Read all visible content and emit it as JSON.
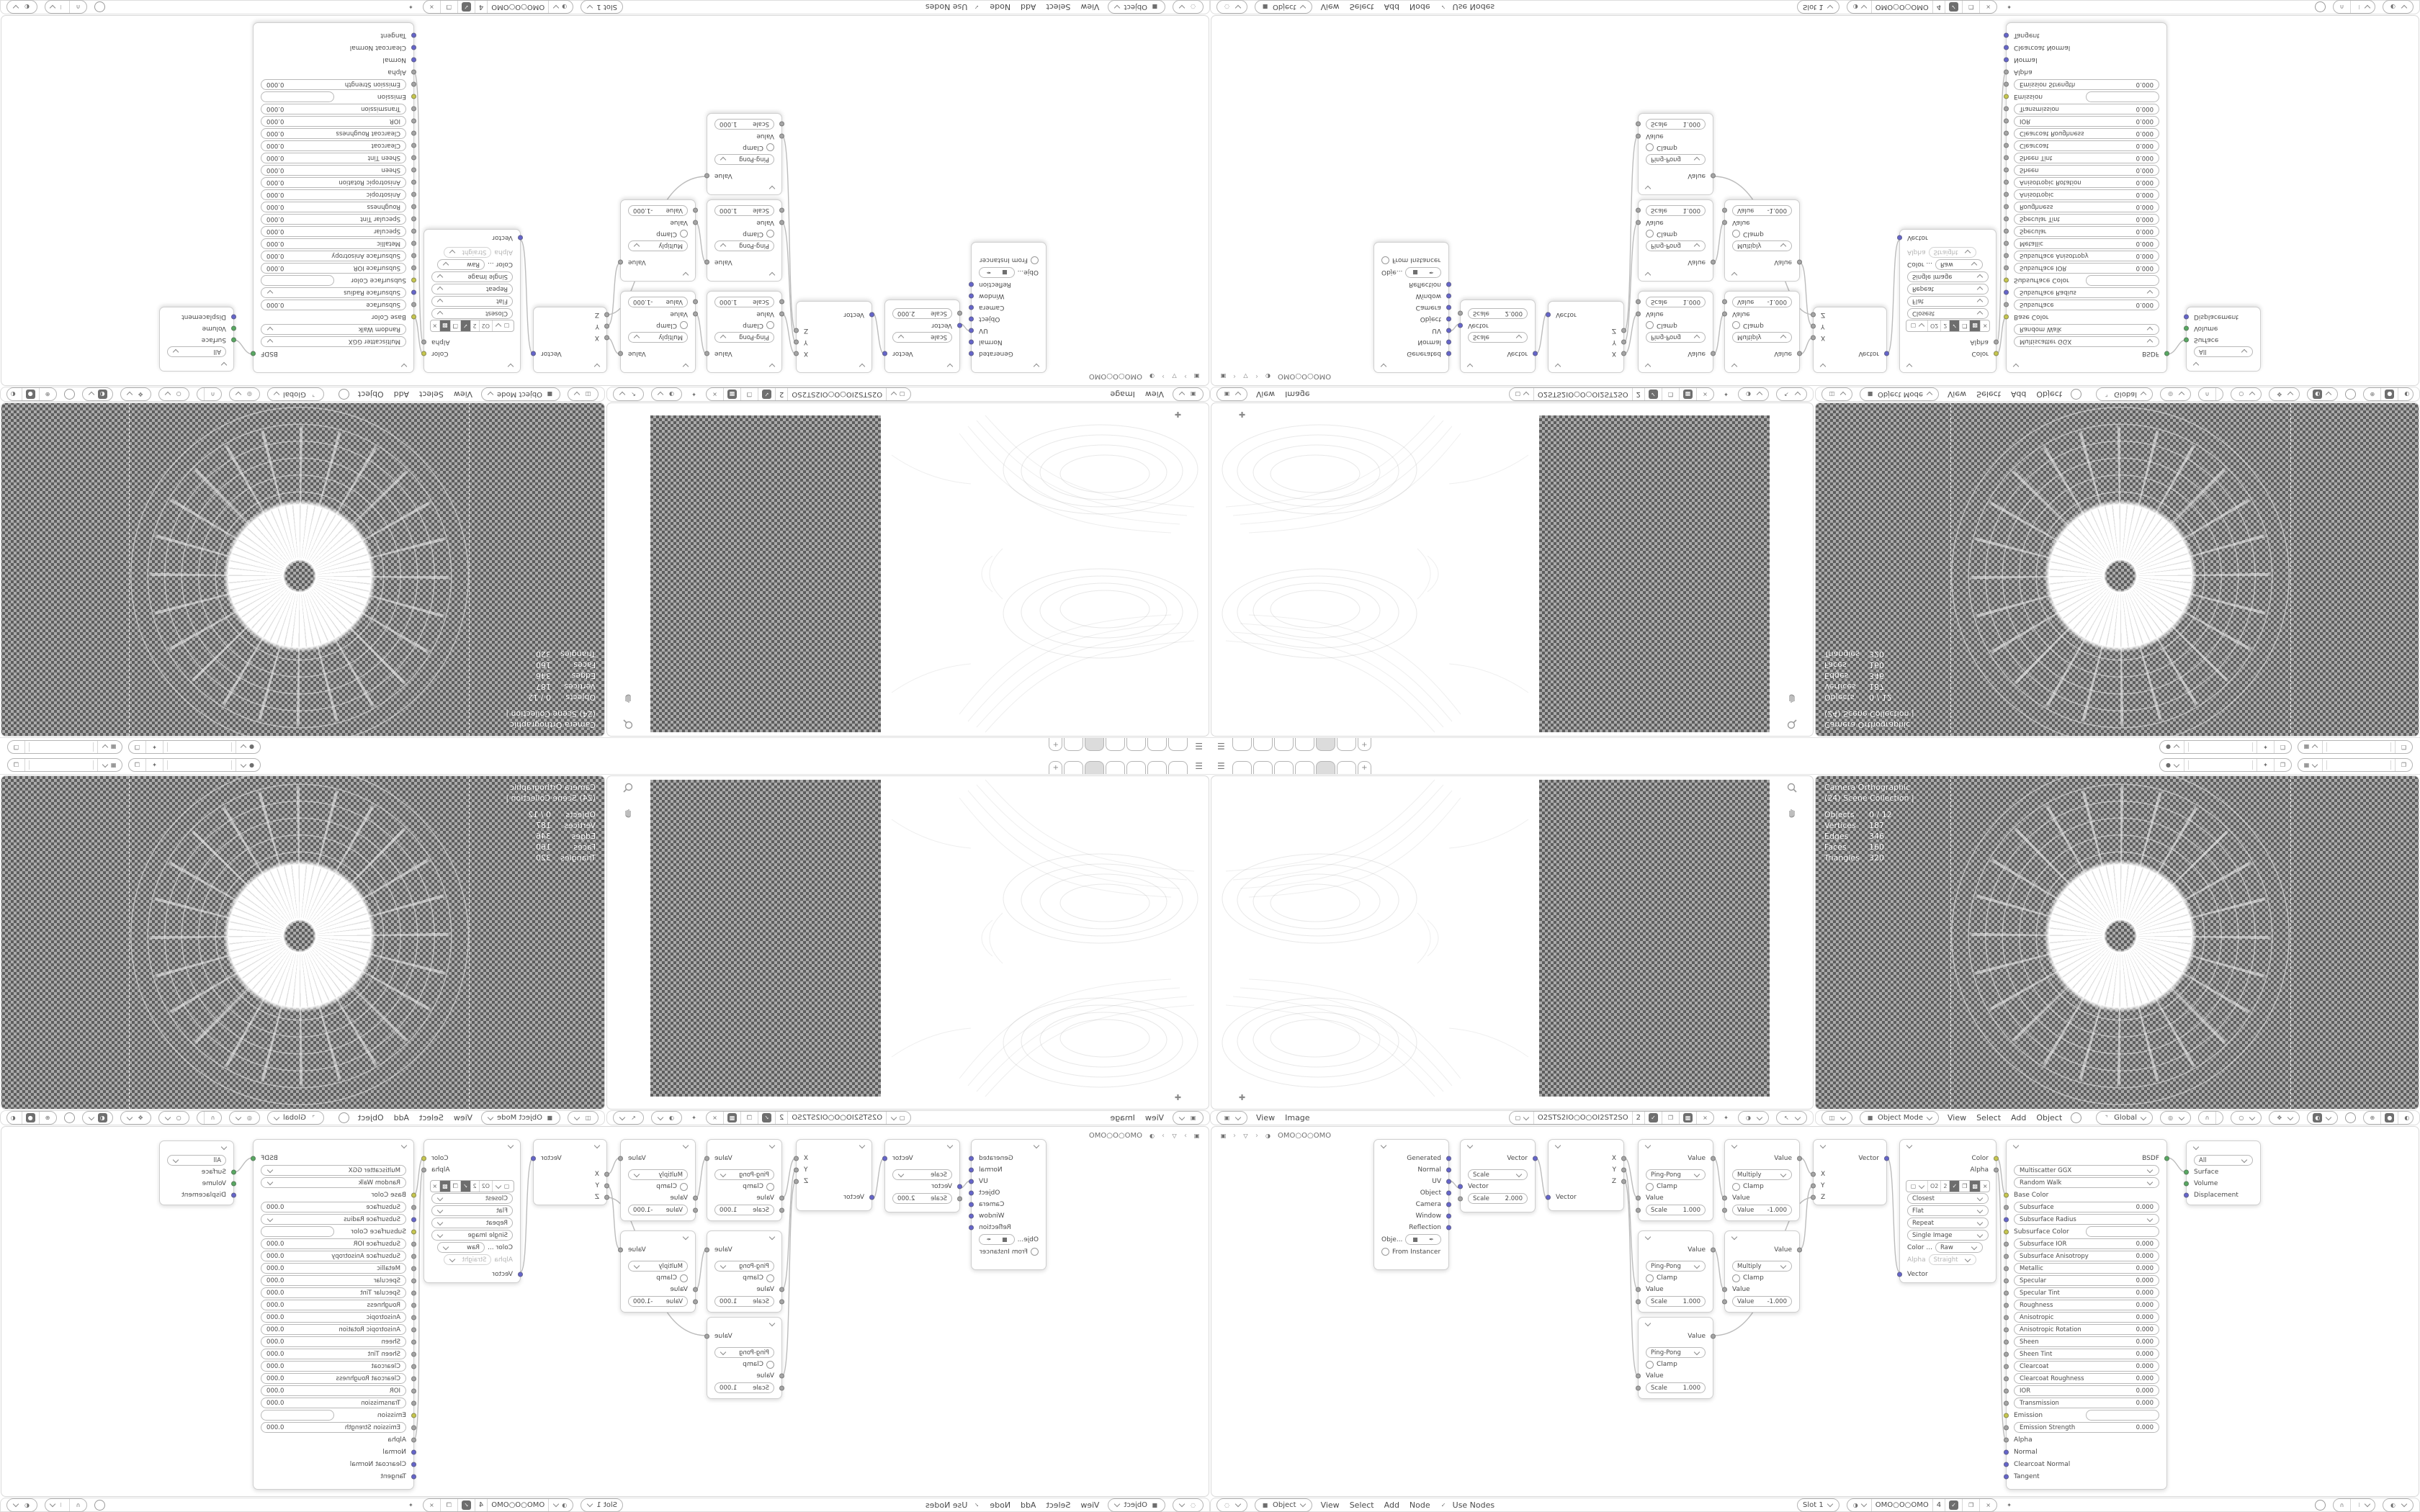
{
  "topbar": {
    "workspace_tab_count": 6,
    "active_tab_index": 4,
    "new_tab_label": "+",
    "scene_value": "",
    "view_layer_value": ""
  },
  "image_editor": {
    "menus": [
      "View",
      "Image"
    ],
    "datablock": {
      "name": "O2STS2IO○O○OI2ST2SO",
      "users": "2"
    }
  },
  "viewport": {
    "header": {
      "mode": "Object Mode",
      "menus": [
        "View",
        "Select",
        "Add",
        "Object"
      ],
      "orientation": "Global"
    },
    "overlay": {
      "line1": "Camera Orthographic",
      "line2": "(24) Scene Collection |",
      "stats": [
        {
          "label": "Objects",
          "value": "0 / 12"
        },
        {
          "label": "Vertices",
          "value": "187"
        },
        {
          "label": "Edges",
          "value": "346"
        },
        {
          "label": "Faces",
          "value": "160"
        },
        {
          "label": "Triangles",
          "value": "320"
        }
      ]
    }
  },
  "shader": {
    "breadcrumb": {
      "material": "OMO○O○OMO"
    },
    "header": {
      "type": "Object",
      "menus": [
        "View",
        "Select",
        "Add",
        "Node"
      ],
      "use_nodes": "Use Nodes",
      "slot": "Slot 1",
      "material": "OMO○O○OMO",
      "users": "4"
    },
    "nodes": {
      "texcoord": {
        "outputs": [
          "Generated",
          "Normal",
          "UV",
          "Object",
          "Camera",
          "Window",
          "Reflection"
        ],
        "object_field": "Obje...",
        "from_instancer": "From Instancer"
      },
      "mapping": {
        "output": "Vector",
        "type": "Scale",
        "vector_in": "Vector",
        "scale_label": "Scale",
        "scale_value": "2.000"
      },
      "separate": {
        "out_x": "X",
        "out_y": "Y",
        "out_z": "Z",
        "vector_in": "Vector"
      },
      "pingpong": {
        "output": "Value",
        "op": "Ping-Pong",
        "clamp": "Clamp",
        "value_in": "Value",
        "field_label": "Scale",
        "field_value": "1.000"
      },
      "multiply": {
        "output": "Value",
        "op": "Multiply",
        "clamp": "Clamp",
        "value_in": "Value",
        "field_label": "Value",
        "field_value": "-1.000"
      },
      "combine": {
        "output": "Vector",
        "in_x": "X",
        "in_y": "Y",
        "in_z": "Z"
      },
      "image_texture": {
        "out_color": "Color",
        "out_alpha": "Alpha",
        "name_short": "O2",
        "users": "2",
        "interpolation": "Closest",
        "projection": "Flat",
        "extension": "Repeat",
        "source": "Single Image",
        "colorspace_label": "Color ...",
        "colorspace": "Raw",
        "alpha_label": "Alpha",
        "alpha_mode": "Straight",
        "vector_in": "Vector"
      },
      "principled": {
        "output": "BSDF",
        "rows": [
          {
            "k": "dropdown",
            "label": "Multiscatter GGX"
          },
          {
            "k": "dropdown",
            "label": "Random Walk"
          },
          {
            "k": "socket",
            "label": "Base Color",
            "c": "yellow"
          },
          {
            "k": "field",
            "label": "Subsurface",
            "value": "0.000",
            "c": "grey"
          },
          {
            "k": "dropdown",
            "label": "Subsurface Radius",
            "c": "vector"
          },
          {
            "k": "color",
            "label": "Subsurface Color",
            "c": "yellow"
          },
          {
            "k": "field",
            "label": "Subsurface IOR",
            "value": "0.000",
            "c": "grey"
          },
          {
            "k": "field",
            "label": "Subsurface Anisotropy",
            "value": "0.000",
            "c": "grey"
          },
          {
            "k": "field",
            "label": "Metallic",
            "value": "0.000",
            "c": "grey"
          },
          {
            "k": "field",
            "label": "Specular",
            "value": "0.000",
            "c": "grey"
          },
          {
            "k": "field",
            "label": "Specular Tint",
            "value": "0.000",
            "c": "grey"
          },
          {
            "k": "field",
            "label": "Roughness",
            "value": "0.000",
            "c": "grey"
          },
          {
            "k": "field",
            "label": "Anisotropic",
            "value": "0.000",
            "c": "grey"
          },
          {
            "k": "field",
            "label": "Anisotropic Rotation",
            "value": "0.000",
            "c": "grey"
          },
          {
            "k": "field",
            "label": "Sheen",
            "value": "0.000",
            "c": "grey"
          },
          {
            "k": "field",
            "label": "Sheen Tint",
            "value": "0.000",
            "c": "grey"
          },
          {
            "k": "field",
            "label": "Clearcoat",
            "value": "0.000",
            "c": "grey"
          },
          {
            "k": "field",
            "label": "Clearcoat Roughness",
            "value": "0.000",
            "c": "grey"
          },
          {
            "k": "field",
            "label": "IOR",
            "value": "0.000",
            "c": "grey"
          },
          {
            "k": "field",
            "label": "Transmission",
            "value": "0.000",
            "c": "grey"
          },
          {
            "k": "color",
            "label": "Emission",
            "c": "yellow"
          },
          {
            "k": "field",
            "label": "Emission Strength",
            "value": "0.000",
            "c": "grey"
          },
          {
            "k": "socket",
            "label": "Alpha",
            "c": "grey"
          },
          {
            "k": "socket",
            "label": "Normal",
            "c": "vector"
          },
          {
            "k": "socket",
            "label": "Clearcoat Normal",
            "c": "vector"
          },
          {
            "k": "socket",
            "label": "Tangent",
            "c": "vector"
          }
        ]
      },
      "output": {
        "target": "All",
        "surface": "Surface",
        "volume": "Volume",
        "displacement": "Displacement"
      }
    }
  },
  "colors": {
    "socket_vector": "#6565cb",
    "socket_value": "#a5a5a5",
    "socket_color": "#c6c64d",
    "socket_shader": "#57a861",
    "checker_light": "#ababab",
    "checker_dark": "#5e5e5e",
    "wire": "#bcbcbc"
  }
}
